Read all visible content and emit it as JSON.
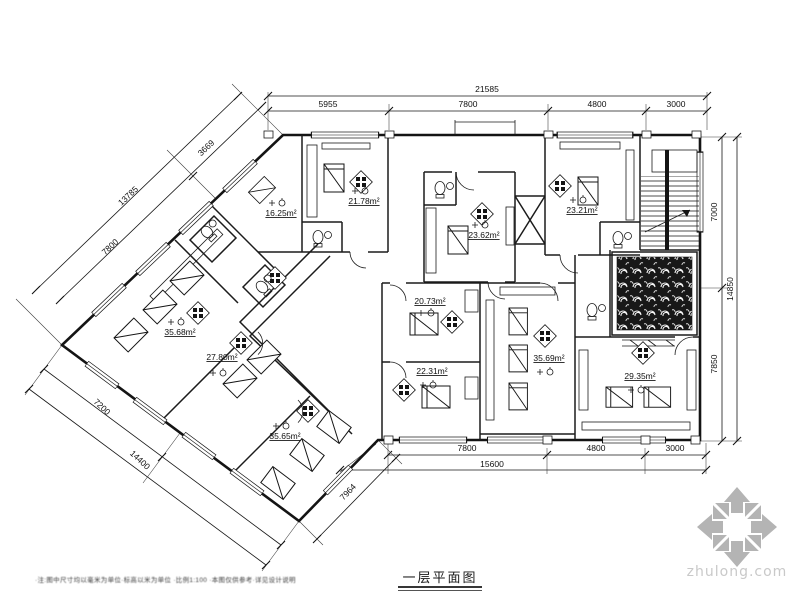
{
  "drawing": {
    "title": "一层平面图",
    "footnote": "·注:图中尺寸均以毫米为单位·标高以米为单位 ·比例1:100 ·本图仅供参考·详见设计说明",
    "watermark": "zhulong.com"
  },
  "rooms": [
    {
      "id": "room-1625",
      "area": "16.25m²"
    },
    {
      "id": "room-2178",
      "area": "21.78m²"
    },
    {
      "id": "room-2362",
      "area": "23.62m²"
    },
    {
      "id": "room-2321",
      "area": "23.21m²"
    },
    {
      "id": "room-3568",
      "area": "35.68m²"
    },
    {
      "id": "room-2780",
      "area": "27.80m²"
    },
    {
      "id": "room-2073",
      "area": "20.73m²"
    },
    {
      "id": "room-2231",
      "area": "22.31m²"
    },
    {
      "id": "room-3565",
      "area": "35.65m²"
    },
    {
      "id": "room-3569",
      "area": "35.69m²"
    },
    {
      "id": "room-2935",
      "area": "29.35m²"
    }
  ],
  "dims": {
    "top": {
      "total": "21585",
      "seg": [
        "5955",
        "7800",
        "4800",
        "3000"
      ]
    },
    "bottom": {
      "total": "15600",
      "seg": [
        "7800",
        "4800",
        "3000"
      ]
    },
    "right": {
      "total": "14850",
      "seg": [
        "7000",
        "7850"
      ]
    },
    "diag_upper_left": {
      "total": "13785",
      "seg": [
        "3669",
        "7800"
      ]
    },
    "diag_lower_left": {
      "total": "14400",
      "seg": [
        "7200"
      ]
    },
    "diag_lower_right": {
      "seg": [
        "7964"
      ]
    }
  }
}
